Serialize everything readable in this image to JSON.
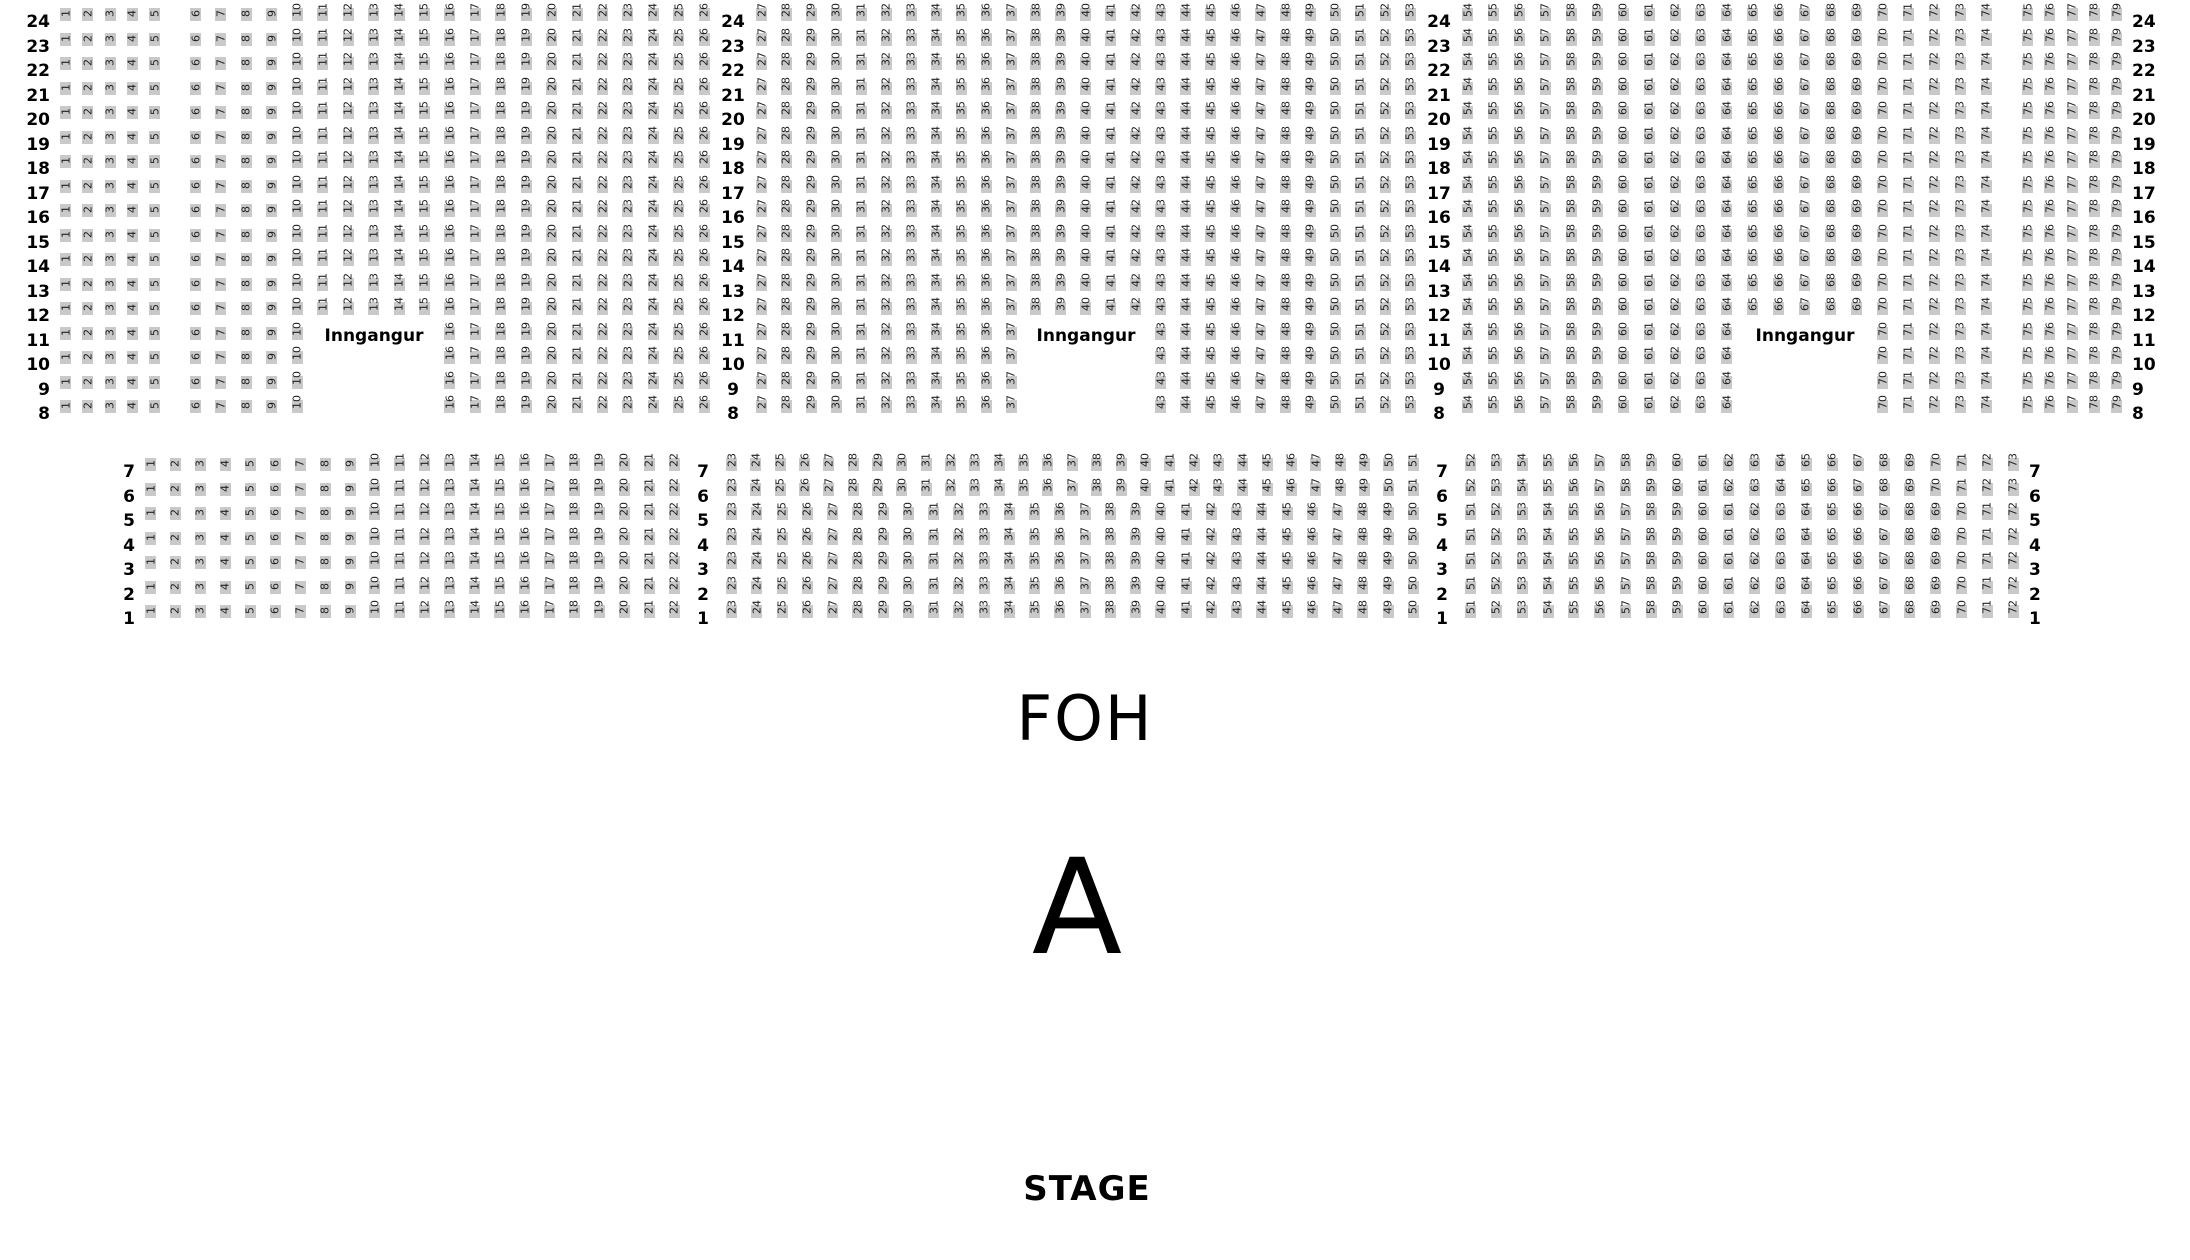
{
  "labels": {
    "entrance": "Inngangur",
    "foh": "FOH",
    "section": "A",
    "stage": "STAGE"
  },
  "colors": {
    "seat_fill": "#c9c9c9",
    "seat_text": "#1f1f1f",
    "label_text": "#000000",
    "background": "#ffffff"
  },
  "top_section": {
    "rows": [
      24,
      23,
      22,
      21,
      20,
      19,
      18,
      17,
      16,
      15,
      14,
      13,
      12,
      11,
      10,
      9,
      8
    ],
    "missing_rows": [
      11,
      10,
      9,
      8
    ],
    "blocks": [
      {
        "start": 1,
        "end": 5
      },
      {
        "start": 6,
        "end": 26,
        "missing_seats": [
          11,
          15
        ]
      },
      {
        "start": 27,
        "end": 53,
        "missing_seats": [
          38,
          42
        ]
      },
      {
        "start": 54,
        "end": 74,
        "missing_seats": [
          65,
          69
        ]
      },
      {
        "start": 75,
        "end": 79
      }
    ],
    "entrances": [
      {
        "label": "Inngangur",
        "at_row": 11,
        "gap_seats": [
          11,
          15
        ]
      },
      {
        "label": "Inngangur",
        "at_row": 11,
        "gap_seats": [
          38,
          42
        ]
      },
      {
        "label": "Inngangur",
        "at_row": 11,
        "gap_seats": [
          65,
          69
        ]
      }
    ]
  },
  "bottom_section": {
    "row_groups": [
      {
        "rows": [
          7,
          6
        ],
        "blocks": [
          {
            "start": 1,
            "end": 22
          },
          {
            "start": 23,
            "end": 51
          },
          {
            "start": 52,
            "end": 73
          }
        ]
      },
      {
        "rows": [
          5,
          4,
          3,
          2,
          1
        ],
        "blocks": [
          {
            "start": 1,
            "end": 22
          },
          {
            "start": 23,
            "end": 50
          },
          {
            "start": 51,
            "end": 72
          }
        ]
      }
    ]
  }
}
